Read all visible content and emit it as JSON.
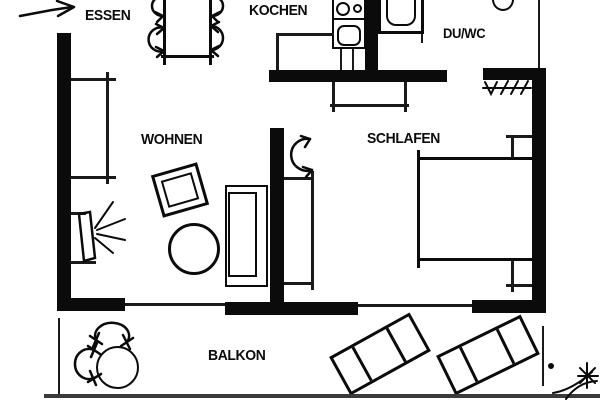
{
  "plan": {
    "type": "apartment-floorplan",
    "rooms": {
      "essen": {
        "label": "ESSEN"
      },
      "kochen": {
        "label": "KOCHEN"
      },
      "duwc": {
        "label": "DU/WC"
      },
      "wohnen": {
        "label": "WOHNEN"
      },
      "schlafen": {
        "label": "SCHLAFEN"
      },
      "balkon": {
        "label": "BALKON"
      }
    },
    "colors": {
      "wall": "#0b0b0b",
      "background": "#ffffff",
      "ground_line": "#3a3a3a"
    },
    "symbols": {
      "entrance": "entrance-arrow",
      "essen": [
        "dining-table",
        "chair",
        "chair",
        "chair",
        "chair"
      ],
      "kochen": [
        "counter",
        "cooktop-two-burners",
        "kitchen-sink"
      ],
      "duwc": [
        "shower-tray",
        "round-washbasin"
      ],
      "wohnen": [
        "wall-shelf",
        "tv-with-rays",
        "armchair",
        "round-coffee-table",
        "sofa"
      ],
      "schlafen": [
        "door-swing",
        "wardrobe",
        "wardrobe",
        "double-bed",
        "nightstand",
        "nightstand",
        "radiator-hatch"
      ],
      "balkon": [
        "round-table",
        "chair",
        "chair",
        "sun-lounger",
        "sun-lounger",
        "plant-sketch"
      ]
    }
  }
}
